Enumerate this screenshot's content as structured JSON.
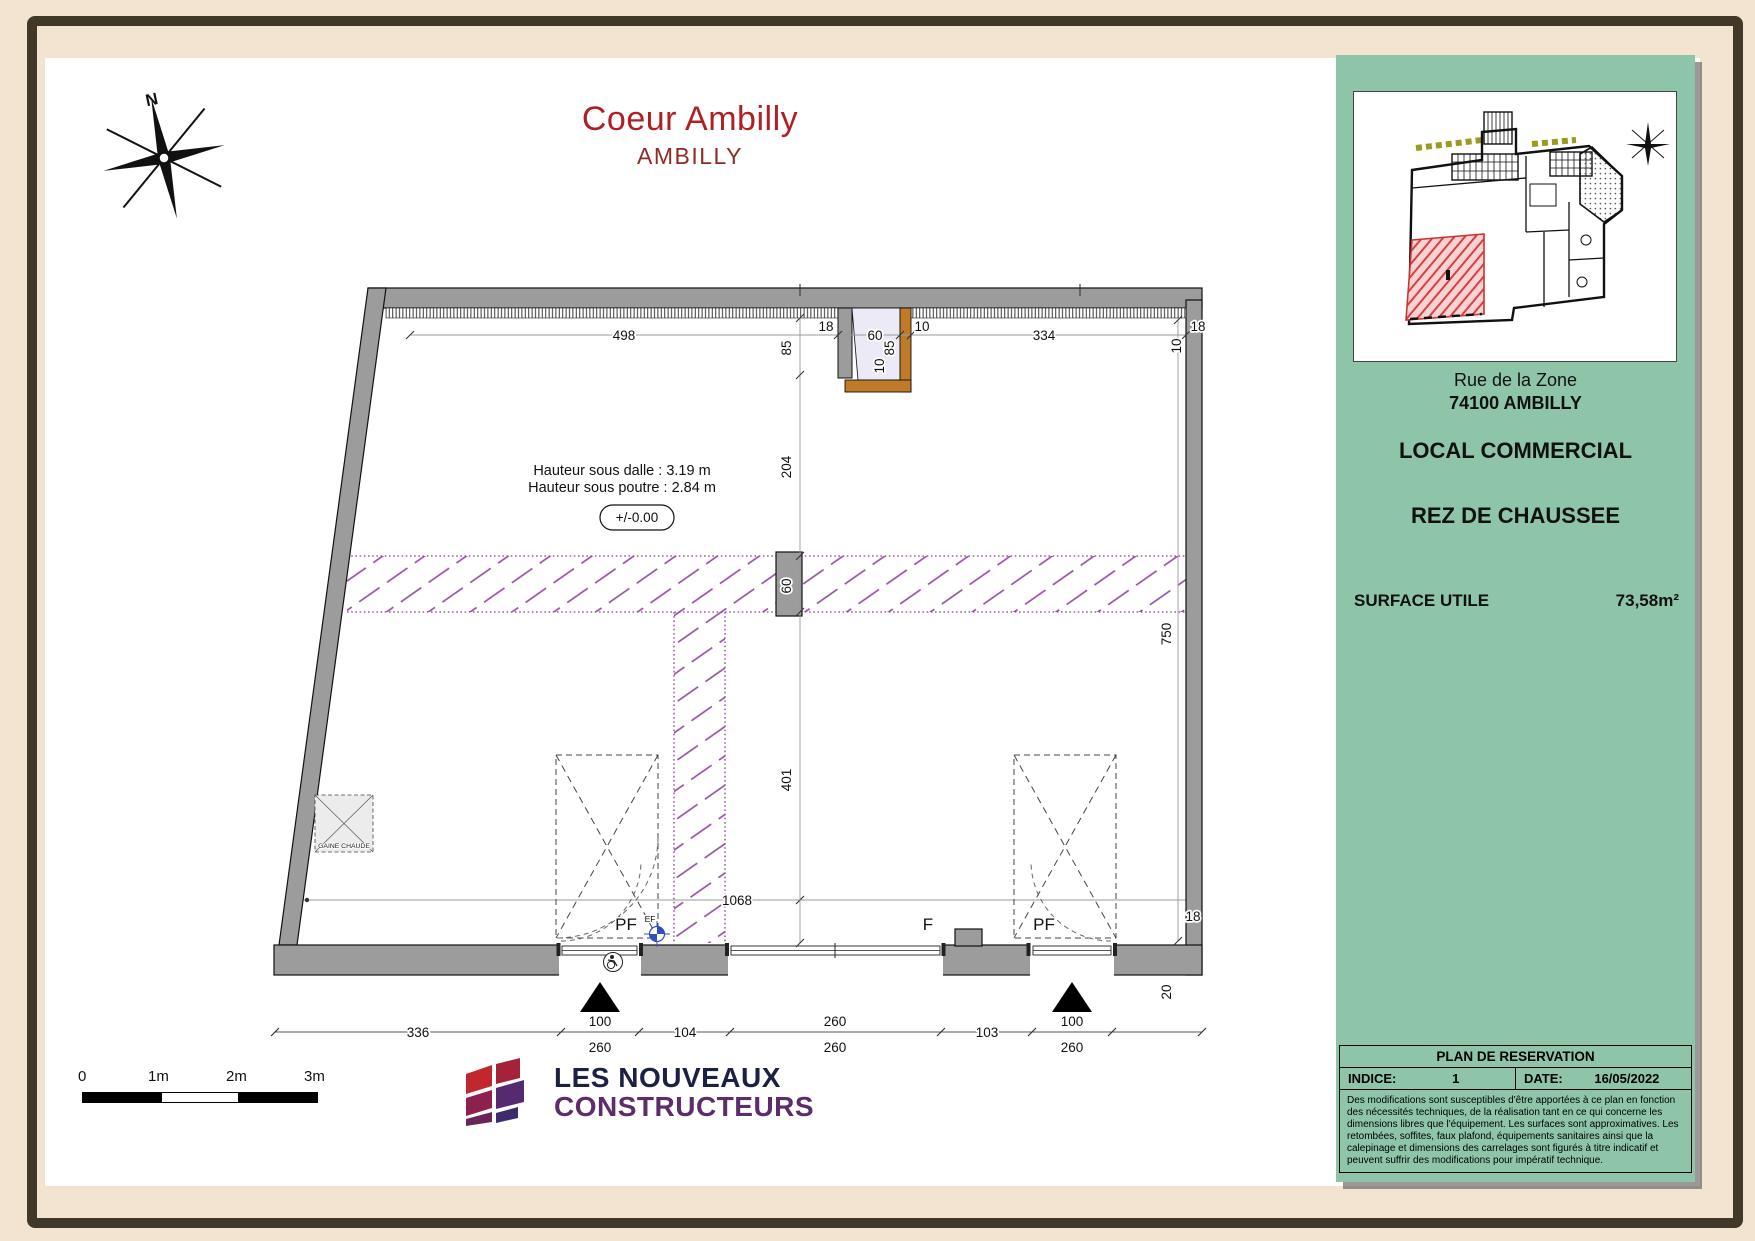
{
  "title": {
    "main": "Coeur Ambilly",
    "sub": "AMBILLY"
  },
  "compass": {
    "north": "N"
  },
  "plan": {
    "notes": {
      "line1": "Hauteur sous dalle : 3.19 m",
      "line2": "Hauteur sous poutre : 2.84 m",
      "level": "+/-0.00"
    },
    "gaine": "GAINE CHAUDE",
    "openings": {
      "pf_left": "PF",
      "ef": "EF",
      "f": "F",
      "pf_right": "PF"
    },
    "dims": {
      "top_498": "498",
      "top_18": "18",
      "niche_60": "60",
      "niche_85": "85",
      "niche_10a": "10",
      "niche_10b": "10",
      "top_334": "334",
      "tr_10": "10",
      "tr_18": "18",
      "v_85": "85",
      "v_204": "204",
      "v_60": "60",
      "v_401": "401",
      "right_750": "750",
      "br_18": "18",
      "br_20": "20",
      "mid_1068": "1068",
      "b_336": "336",
      "b_104": "104",
      "b_103": "103",
      "d1_w": "100",
      "d1_h": "260",
      "w_w": "260",
      "w_h": "260",
      "d2_w": "100",
      "d2_h": "260"
    }
  },
  "scalebar": {
    "t0": "0",
    "t1": "1m",
    "t2": "2m",
    "t3": "3m"
  },
  "logo": {
    "line1": "LES NOUVEAUX",
    "line2": "CONSTRUCTEURS"
  },
  "sidebar": {
    "address1": "Rue de la Zone",
    "address2": "74100 AMBILLY",
    "type": "LOCAL COMMERCIAL",
    "floor": "REZ DE CHAUSSEE",
    "surface_label": "SURFACE UTILE",
    "surface_value": "73,58m²",
    "table": {
      "title": "PLAN DE RESERVATION",
      "indice_label": "INDICE:",
      "indice_value": "1",
      "date_label": "DATE:",
      "date_value": "16/05/2022",
      "disclaimer": "Des modifications sont susceptibles d'être apportées à ce plan en fonction des nécessités techniques, de la réalisation tant en ce qui concerne les dimensions libres que l'équipement. Les surfaces sont approximatives. Les retombées, soffites, faux plafond, équipements sanitaires ainsi que la calepinage et dimensions des carrelages sont figurés à titre indicatif et peuvent suffrir des modifications pour impératif technique."
    }
  },
  "colors": {
    "panel_green": "#8ec5a9",
    "title_red": "#b01f24",
    "subtitle_maroon": "#8e2b26",
    "reservation_purple": "#8d3f9d",
    "wall_gray": "#9c9c9c",
    "niche_orange": "#bf7b28",
    "unit_red": "#e05252"
  }
}
